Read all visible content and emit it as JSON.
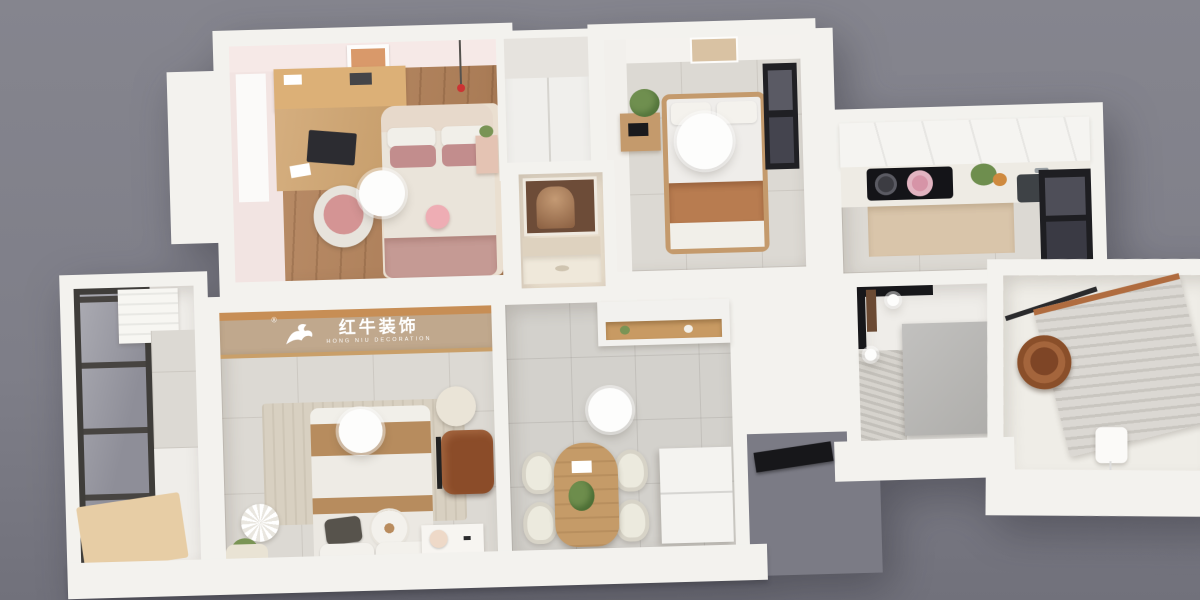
{
  "scene": {
    "description": "3D axonometric dollhouse render of a small apartment floor plan on a gray backdrop",
    "background_color": "#7e7e88",
    "wall_color": "#f3f2ee"
  },
  "banner": {
    "logo_cn": "红牛装饰",
    "logo_en": "HONG NIU DECORATION",
    "registered_mark": "®",
    "banner_color": "#c0a88d",
    "wood_trim_color": "#c78e55"
  },
  "palette": {
    "wood_floor": "#b5835a",
    "tile_floor": "#dcd9d3",
    "pink_wall": "#f2e4e2",
    "terracotta_blanket": "#b87c50",
    "mauve_pillow": "#c28d8d",
    "leather_chair": "#8b4c29",
    "copper_basin": "#a4653c",
    "kitchen_cabinet_beige": "#d9c5aa",
    "window_frame": "#202024"
  },
  "rooms": [
    {
      "id": "kids-bedroom",
      "furniture": [
        "study-desk-with-hutch",
        "laptop",
        "pink-desk-chair",
        "double-bed",
        "mauve-pillows",
        "plush-bunny",
        "nightstand",
        "wall-art",
        "ceiling-lamp",
        "pendant-lamp",
        "rug"
      ]
    },
    {
      "id": "guest-bedroom",
      "furniture": [
        "single-bed",
        "terracotta-blanket",
        "wood-nightstand",
        "clock-radio",
        "plant",
        "wall-art",
        "window",
        "ceiling-lamp"
      ]
    },
    {
      "id": "bathroom-vanity",
      "furniture": [
        "mirror",
        "vanity-counter",
        "vanity-cabinet"
      ]
    },
    {
      "id": "kitchen",
      "furniture": [
        "upper-cabinets",
        "cooktop",
        "pink-pot",
        "pan",
        "groceries",
        "sink",
        "window",
        "tall-cabinets"
      ]
    },
    {
      "id": "shower-room",
      "furniture": [
        "glass-partition",
        "partition-block",
        "floor-drain",
        "ceiling-spotlights"
      ]
    },
    {
      "id": "laundry-room",
      "furniture": [
        "drying-rack",
        "copper-basin",
        "hanging-rod",
        "wall-switch"
      ]
    },
    {
      "id": "master-bedroom",
      "furniture": [
        "brand-banner",
        "double-bed",
        "flower-pillow",
        "dark-pillow",
        "rug",
        "leather-chair",
        "pouf",
        "paper-fan-flower",
        "plant",
        "basket",
        "nightstand",
        "ball-lamp",
        "ceiling-lamp"
      ]
    },
    {
      "id": "dining-area",
      "furniture": [
        "arched-dining-table",
        "four-chairs",
        "table-plant",
        "refrigerator",
        "niche-cabinet",
        "ceiling-lamp"
      ]
    },
    {
      "id": "balcony",
      "furniture": [
        "glazed-window-wall",
        "washing-machine",
        "tiled-wall",
        "wood-deck"
      ]
    },
    {
      "id": "entrance",
      "furniture": [
        "entry-door"
      ]
    }
  ]
}
